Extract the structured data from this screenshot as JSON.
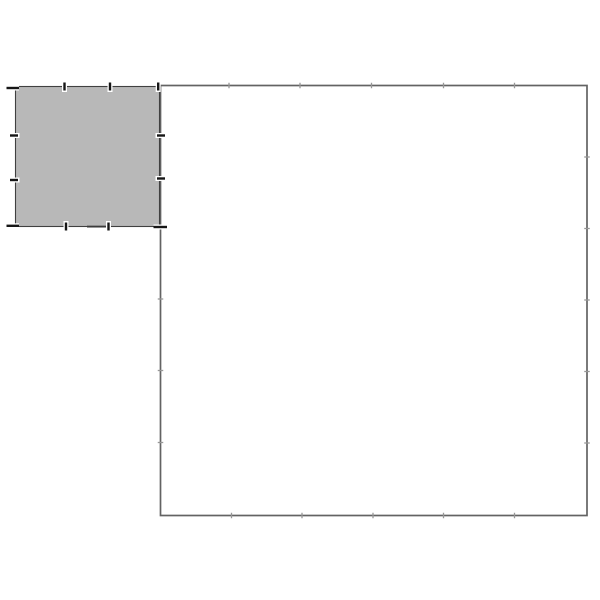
{
  "canvas": {
    "width": 600,
    "height": 600,
    "background_color": "#ffffff"
  },
  "figure": {
    "outer_rectangle": {
      "x": 160.5,
      "y": 85.5,
      "width": 426.5,
      "height": 430,
      "fill_color": "#ffffff",
      "stroke_color": "#636363",
      "stroke_width": 1.7,
      "tick_color": "#979797",
      "tick_length": 5.5,
      "tick_width": 1.3,
      "ticks_top_x": [
        229,
        300,
        371.5,
        443.5,
        514.5
      ],
      "ticks_bottom_x": [
        231.5,
        302,
        373,
        443.5,
        514.5
      ],
      "ticks_right_y": [
        157,
        228.5,
        300,
        371.5,
        443
      ],
      "ticks_left_y": [
        299,
        370.5,
        442.5
      ]
    },
    "inner_square": {
      "x": 15.5,
      "y": 86.5,
      "width": 144,
      "height": 140,
      "fill_color": "#b8b8b8",
      "stroke_color": "#404040",
      "stroke_width": 1.1,
      "tick_color": "#141414",
      "tick_halo_color": "#ffffff",
      "tick_length": 8,
      "tick_width": 2.4,
      "ticks_top_x": [
        64.5,
        110,
        158.2
      ],
      "ticks_bottom_x": [
        66,
        108.5
      ],
      "ticks_left_y": [
        135.5,
        180
      ],
      "ticks_right_y": [
        135.5,
        178.5
      ],
      "corner_dashes": [
        {
          "x": 6.5,
          "y": 88,
          "length": 12.5
        },
        {
          "x": 6.5,
          "y": 225.8,
          "length": 12.5
        },
        {
          "x": 153.5,
          "y": 227,
          "length": 13.5
        }
      ],
      "edge_smudge": {
        "x": 87,
        "y": 225.6,
        "length": 19,
        "thickness": 2,
        "color": "#3a3a3a"
      }
    }
  }
}
